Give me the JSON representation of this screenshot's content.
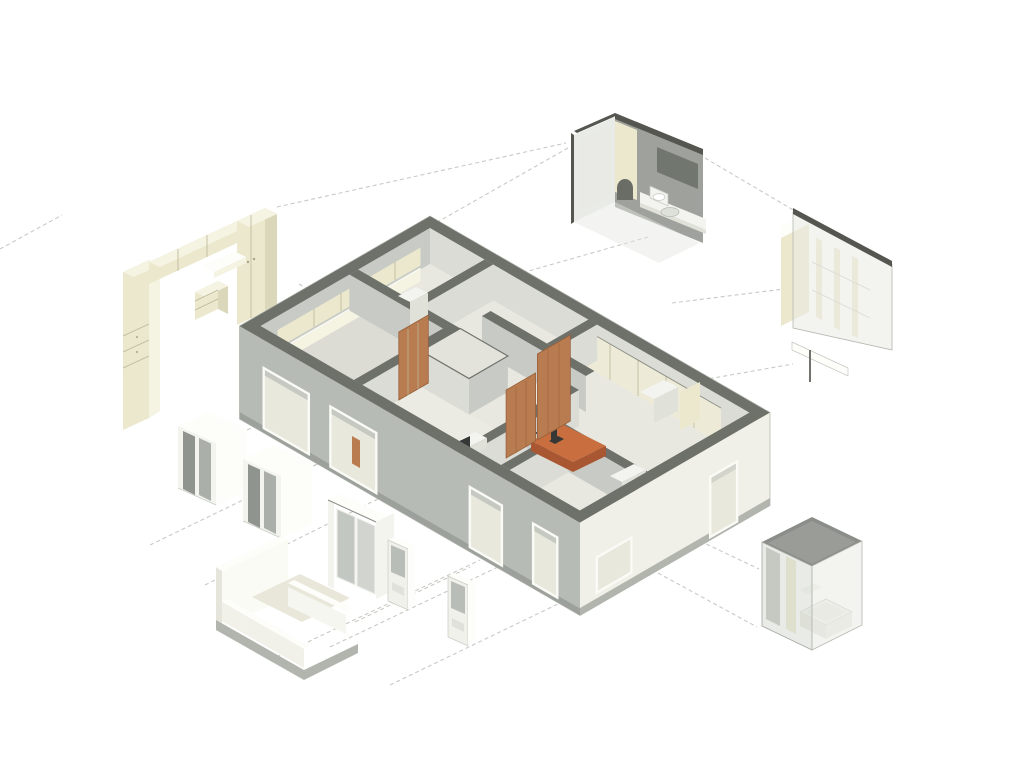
{
  "scene": {
    "title": "Exploded axonometric diagram of an apartment unit",
    "type": "architectural-exploded-axonometric",
    "background": "#ffffff"
  },
  "palette": {
    "bg": "#ffffff",
    "dash": "#c9c9c4",
    "outline": "#aeb1a9",
    "wallTop": "#6e716a",
    "wallTopDeep": "#54564f",
    "facadeSW": "#b7bbb5",
    "facadeSE": "#f1f0e8",
    "slabEdgeDark": "#9da19b",
    "slabEdge": "#b2b5ae",
    "intWallLight": "#dadcd5",
    "intWallMid": "#c8cbc5",
    "intWallDark": "#9fa29c",
    "floorMain": "#e8e8e1",
    "floorShade": "#dcdcd4",
    "floorTint": "#ebebe3",
    "cream": "#ebe8ce",
    "creamLight": "#f5f3e1",
    "creamMid": "#edebd8",
    "creamDark": "#dbd7ba",
    "creamLine": "#c2be9f",
    "wood": "#b97c50",
    "woodDark": "#97603a",
    "orange": "#c96f3f",
    "orangeDark": "#a85732",
    "glassPane": "#8f948f",
    "glassPaneLight": "#abafaa",
    "mirror": "#71766f",
    "fixture": "#f3f4ef",
    "fixtureShade": "#e0e2da",
    "darkItem": "#353836",
    "windowInterior": "#e9e8dd",
    "glassFillA": "rgba(233,234,227,0.55)",
    "glassFillB": "rgba(219,221,213,0.60)"
  },
  "modules": {
    "apartment": {
      "label": "Apartment unit cutaway with interior partitions, wood doors and orange breakfast bar"
    },
    "kitchen_cabinets": {
      "label": "Exploded kitchen and wardrobe cabinetry module (cream)"
    },
    "bathroom_top": {
      "label": "Exploded bathroom module with mirror, vanity counter and toilet"
    },
    "wardrobe": {
      "label": "Exploded translucent wardrobe / closet module"
    },
    "bathroom_tub": {
      "label": "Exploded translucent bathroom module with bathtub"
    },
    "window_1": {
      "label": "Exploded sliding window unit"
    },
    "window_2": {
      "label": "Exploded sliding window unit"
    },
    "sliding_door": {
      "label": "Exploded sliding door unit"
    },
    "door_1": {
      "label": "Exploded single door unit"
    },
    "door_2": {
      "label": "Exploded single door unit"
    },
    "balcony": {
      "label": "Exploded balcony module with parapet"
    }
  },
  "annotations": {
    "projection_lines": "light gray dashed tie lines linking exploded parts to the plan",
    "line_count": 17
  }
}
